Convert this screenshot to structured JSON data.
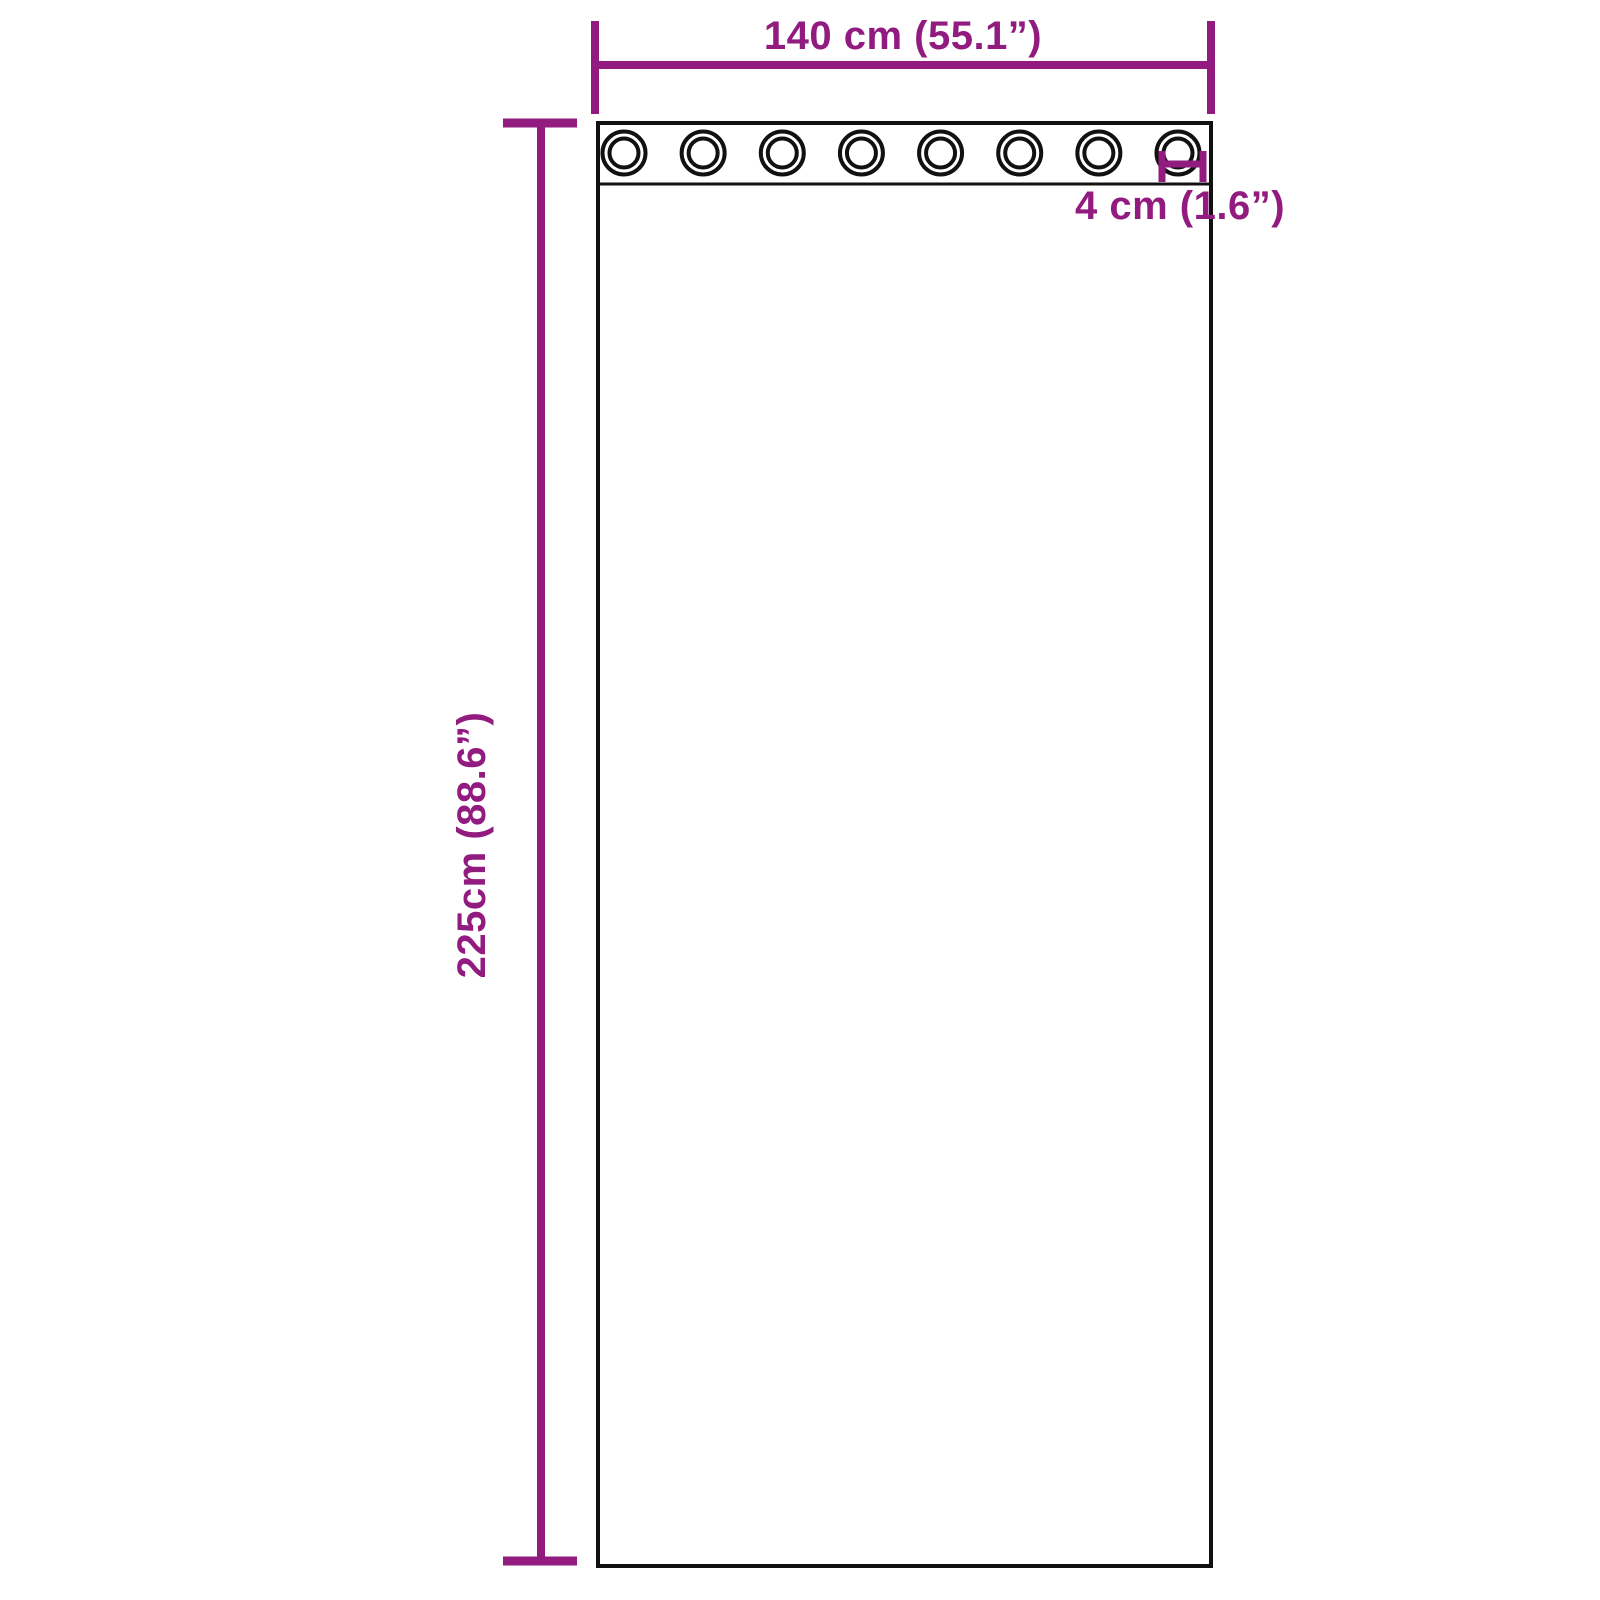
{
  "diagram": {
    "title": "curtain-dimension-diagram",
    "labels": {
      "width": "140 cm (55.1”)",
      "height": "225cm (88.6”)",
      "grommet": "4 cm (1.6”)"
    },
    "grommets": {
      "count": 8
    },
    "colors": {
      "dimension_accent": "#921B7F",
      "outline": "#111111",
      "background": "#FFFFFF"
    }
  }
}
